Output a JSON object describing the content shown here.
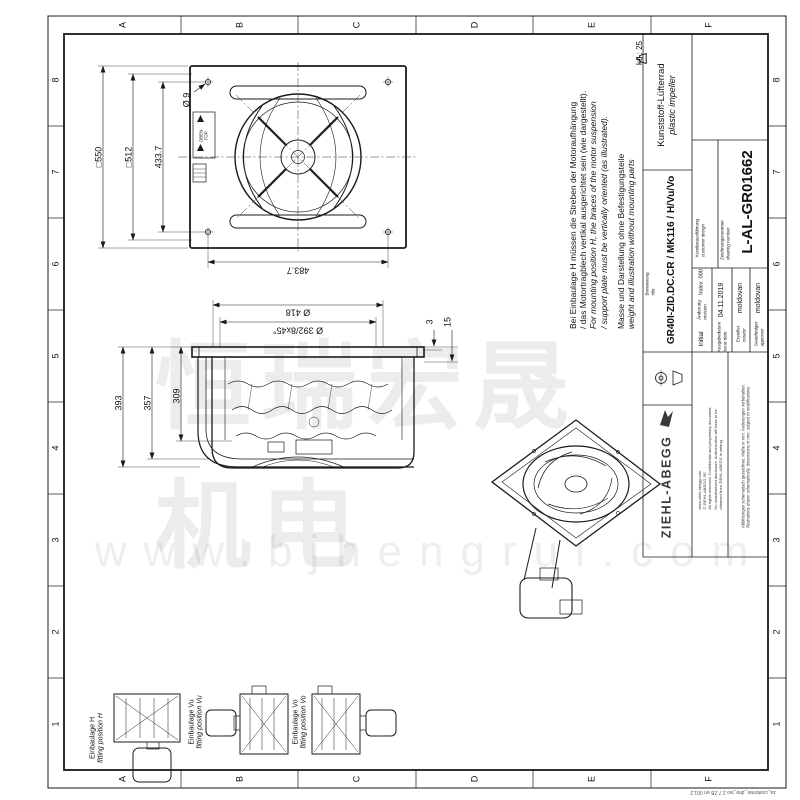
{
  "sheet": {
    "border_columns": [
      "A",
      "B",
      "C",
      "D",
      "E",
      "F"
    ],
    "border_rows": [
      "8",
      "7",
      "6",
      "5",
      "4",
      "3",
      "2",
      "1"
    ],
    "weight_label": "kg : 25"
  },
  "views": {
    "front": {
      "dims": {
        "outer_square": "□550",
        "inner_square": "□512",
        "hole_pitch_vertical": "433.7",
        "hole_pitch_horizontal": "483.7",
        "hole_diameter": "Ø 9"
      },
      "labels": {
        "oben": "OBEN",
        "top": "TOP"
      }
    },
    "side": {
      "dims": {
        "inlet_diameter": "Ø 418",
        "bolt_circle": "Ø 392/8x45°",
        "depth_total": "393",
        "depth_to_bracket": "357",
        "depth_to_cone": "309",
        "plate_thickness": "3",
        "flange_depth": "15"
      }
    }
  },
  "notes": {
    "mounting_de_1": "Bei Einbaulage H müssen die Streben der Motoraufhängung",
    "mounting_de_2": "/ das Motortragblech vertikal ausgerichtet sein (wie dargestellt).",
    "mounting_en_1": "For mounting position H, the braces of the motor suspension",
    "mounting_en_2": "/ support plate must be vertically oriented (as illustrated).",
    "weight_de": "Masse und Darstellung ohne Befestigungsteile",
    "weight_en": "weight and illustration without mounting parts"
  },
  "fitting_positions": [
    {
      "de": "Einbaulage H",
      "en": "fitting position H"
    },
    {
      "de": "Einbaulage Vu",
      "en": "fitting position Vu"
    },
    {
      "de": "Einbaulage Vo",
      "en": "fitting position Vo"
    }
  ],
  "title_block": {
    "benennung_label": "Benennung",
    "benennung_label_en": "title",
    "title_value": "GR40I-ZID.DC.CR / MK116 / H/Vu/Vo",
    "product_de": "Kunststoff-Lüfterrad",
    "product_en": "plastic impeller",
    "index_label": "Index",
    "index_value": "000",
    "revision_label_de": "Änderung",
    "revision_label_en": "revision",
    "revision_value": "Initial",
    "issue_label_de": "Ausgabedatum",
    "issue_label_en": "issue date",
    "issue_value": "04.11.2019",
    "creator_label_de": "Ersteller",
    "creator_label_en": "creator",
    "creator_value": "moldovan",
    "approver_label_de": "Genehmiger",
    "approver_label_en": "approver",
    "approver_value": "moldovan",
    "customer_label_de": "Kundenausführung",
    "customer_label_en": "customer design",
    "drawing_no_label_de": "Zeichnungsnummer",
    "drawing_no_label_en": "drawing number",
    "drawing_no": "L-AL-GR01662",
    "brand": "ZIEHL-ABEGG",
    "legal_lines": [
      "www.ziehl-abegg.com",
      "© ZIEHL-ABEGG SE",
      "All rights reserved. Confidential and proprietary document.",
      "No unauthorized disclosure. Authorization will have to be",
      "obtained from ZIEHL-ABEGG in writing."
    ],
    "mod_de": "Abbildungen schematisch gezeichnet. Maße in mm. Änderungen vorbehalten.",
    "mod_en": "illustrations drawn schematically. dimensions in mm. subject to modifications"
  },
  "watermark": {
    "cjk": "恒瑞宏晟机电",
    "url": "www.bjhengrui.com"
  },
  "footer": {
    "form_id": "za_customer_drw_iso 2.7 ZB en 001.2"
  }
}
